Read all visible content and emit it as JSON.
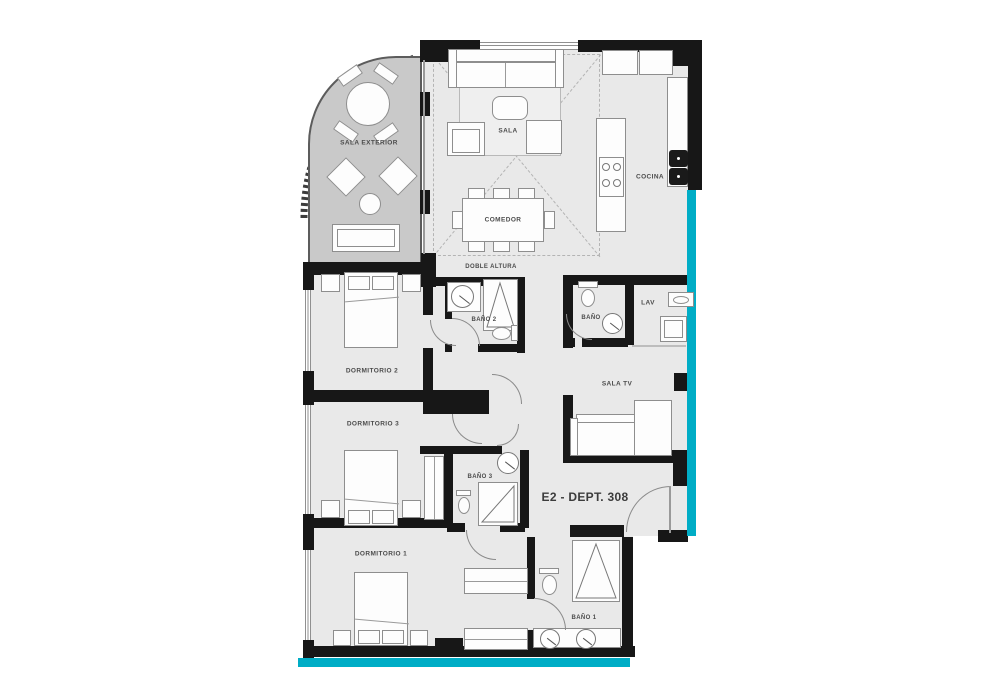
{
  "plan": {
    "unit_label": "E2 - DEPT. 308"
  },
  "rooms": {
    "sala_exterior": "SALA EXTERIOR",
    "sala": "SALA",
    "comedor": "COMEDOR",
    "cocina": "COCINA",
    "doble_altura": "DOBLE ALTURA",
    "bano_2": "BAÑO 2",
    "bano": "BAÑO",
    "lav": "LAV",
    "dormitorio_2": "DORMITORIO 2",
    "sala_tv": "SALA TV",
    "dormitorio_3": "DORMITORIO 3",
    "bano_3": "BAÑO 3",
    "dormitorio_1": "DORMITORIO 1",
    "bano_1": "BAÑO 1"
  },
  "colors": {
    "accent": "#00adc6",
    "wall": "#171717",
    "floor": "#e9e9e9",
    "terrace": "#c9c9c9",
    "furn_line": "#8e8e8e",
    "label": "#4b4b4b"
  }
}
